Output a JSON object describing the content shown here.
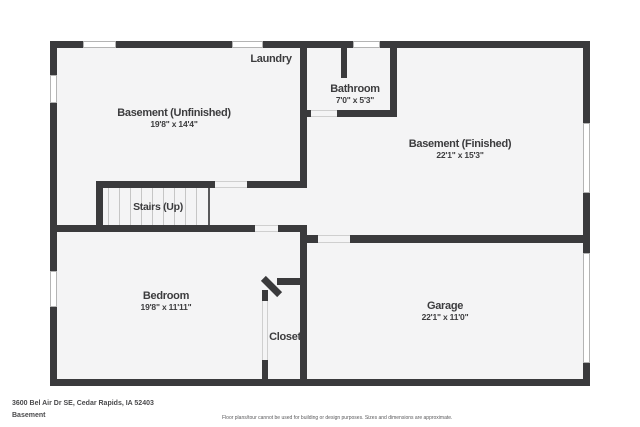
{
  "rooms": {
    "laundry": {
      "label": "Laundry"
    },
    "basement_unfinished": {
      "label": "Basement (Unfinished)",
      "dims": "19'8\" x 14'4\""
    },
    "bathroom": {
      "label": "Bathroom",
      "dims": "7'0\" x 5'3\""
    },
    "basement_finished": {
      "label": "Basement (Finished)",
      "dims": "22'1\" x 15'3\""
    },
    "stairs": {
      "label": "Stairs (Up)"
    },
    "bedroom": {
      "label": "Bedroom",
      "dims": "19'8\" x 11'11\""
    },
    "closet": {
      "label": "Closet"
    },
    "garage": {
      "label": "Garage",
      "dims": "22'1\" x 11'0\""
    }
  },
  "footer": {
    "address": "3600 Bel Air Dr SE, Cedar Rapids, IA 52403",
    "level": "Basement",
    "disclaimer": "Floor plans/tour cannot be used for building or design purposes. Sizes and dimensions are approximate."
  },
  "colors": {
    "wall": "#3a3a3c",
    "floor": "#f4f4f5",
    "text": "#3c3c3e",
    "window_border": "#b4b4b4",
    "background": "#ffffff"
  }
}
